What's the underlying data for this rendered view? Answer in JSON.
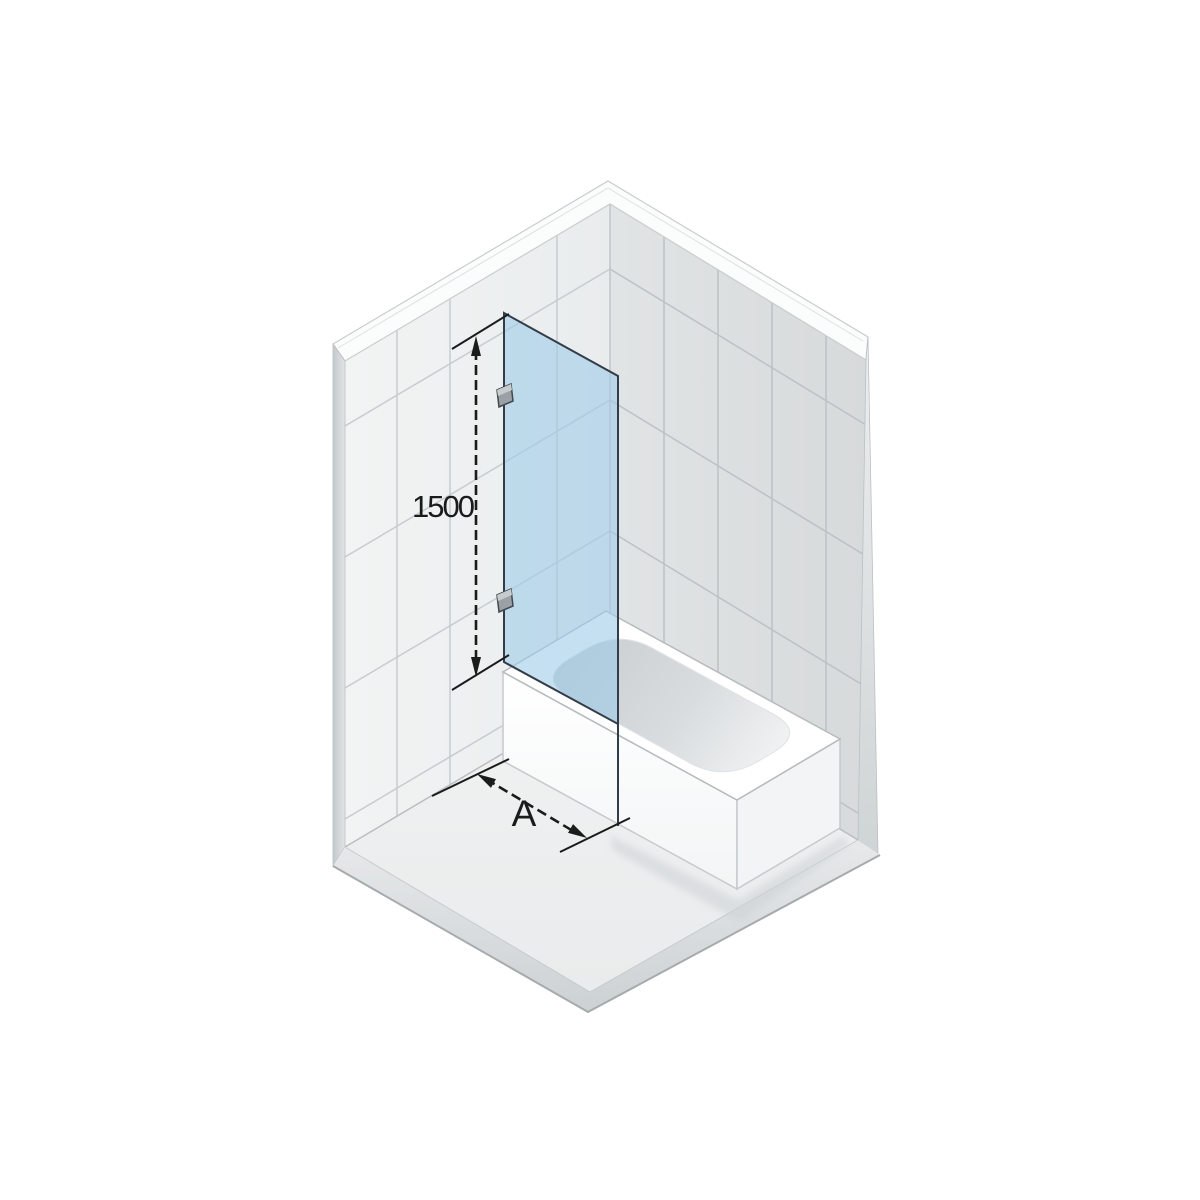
{
  "diagram": {
    "title": "bath-screen-dimension-diagram",
    "labels": {
      "height_dimension": "1500",
      "width_dimension": "A"
    },
    "components": [
      "tiled-wall-left",
      "tiled-wall-right",
      "floor",
      "bathtub",
      "glass-bath-screen",
      "wall-hinge-top",
      "wall-hinge-bottom",
      "height-dimension-line",
      "width-dimension-line"
    ],
    "colors": {
      "background": "#ffffff",
      "wall_left_tile": "#edf0f0",
      "wall_right_tile": "#dde0e1",
      "grout_left": "#c7ccce",
      "grout_right": "#bcc1c3",
      "edge_band": "#fbfcfc",
      "floor": "#eff1f1",
      "slab_side": "#d5d9db",
      "tub_white": "#ffffff",
      "tub_end_face": "#f2f4f5",
      "basin_shade": "#c7cccf",
      "glass_fill": "#9ecbe8",
      "glass_outline": "#333d49",
      "hinge_fill": "#9aa0a5",
      "hinge_outline": "#40484e",
      "hinge_highlight": "#c6cbcd",
      "dimension_color": "#1b1b1b"
    }
  }
}
